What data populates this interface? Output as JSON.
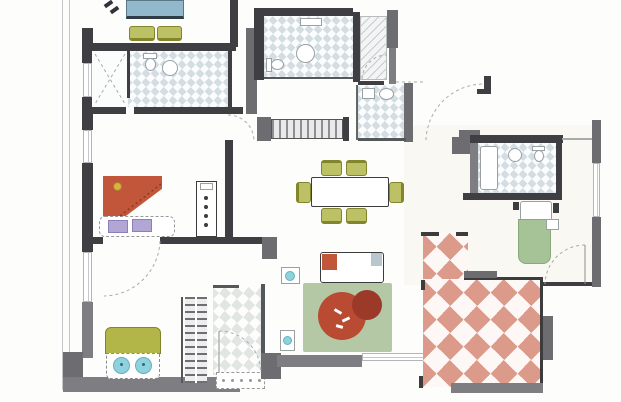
{
  "meta": {
    "kind": "apartment floor plan, top-down architectural drawing, no text labels"
  },
  "palette": {
    "floor": "#fdfdfc",
    "cream": "#faf8f2",
    "ink": "#3c3c3c",
    "wall-dark": "#3f3f43",
    "wall-mid": "#6d6d71",
    "wall-gray": "#7e7e82",
    "line": "#a6abae",
    "tile-blue": "#d3dde2",
    "tile-entry": "#e2e6e2",
    "terrace-red": "#dc9a8a",
    "olive": "#b2b648",
    "olive-dark": "#82852c",
    "chair": "#bcc166",
    "sage": "#a6c297",
    "rug": "#b4c8a6",
    "terracotta": "#c1563a",
    "plant": "#b84b32",
    "plant-dark": "#9c3a29",
    "table-blue": "#92b9cb",
    "teal": "#8fd2dd",
    "lavender": "#b2a7d4"
  },
  "rooms": [
    {
      "id": "balcony-top-left",
      "features": [
        "blue-table",
        "two-olive-chairs",
        "grill-marks"
      ]
    },
    {
      "id": "bathroom-top-left",
      "floor": "blue-diamond-tile",
      "features": [
        "shower-corner-with-dashed-x",
        "toilet",
        "round-sink"
      ]
    },
    {
      "id": "bathroom-top-center",
      "floor": "blue-diamond-tile",
      "features": [
        "toilet",
        "round-sink"
      ]
    },
    {
      "id": "closet-hatched",
      "floor": "diagonal-hatch",
      "features": [
        "door-arc"
      ]
    },
    {
      "id": "wc-small",
      "floor": "blue-diamond-tile",
      "features": [
        "cistern",
        "basin"
      ]
    },
    {
      "id": "hallway-center",
      "features": [
        "striped-wardrobe",
        "dining-set",
        "door-swing-arc"
      ]
    },
    {
      "id": "study-left",
      "features": [
        "terracotta-corner-sofa",
        "mat-with-lavender-cushions",
        "bookshelf"
      ]
    },
    {
      "id": "bedroom-bottom-left",
      "features": [
        "olive-double-bed",
        "two-teal-round-pillows"
      ]
    },
    {
      "id": "entry-hall",
      "floor": "light-diamond-tile",
      "features": [
        "door-arc",
        "dotted-doormat",
        "staircase"
      ]
    },
    {
      "id": "living-room",
      "features": [
        "white-sofa",
        "red-cushion",
        "sage-rug",
        "red-plant",
        "two-side-tables"
      ]
    },
    {
      "id": "bathroom-right",
      "floor": "blue-diamond-tile",
      "features": [
        "shower",
        "round-sink",
        "toilet"
      ]
    },
    {
      "id": "bedroom-right",
      "features": [
        "sage-single-bed",
        "white-pillow",
        "nightstands",
        "door-arc"
      ]
    },
    {
      "id": "terrace-bottom-right",
      "floor": "red-diamond-tile",
      "features": [
        "corner-ticks",
        "perimeter-walls"
      ]
    }
  ]
}
